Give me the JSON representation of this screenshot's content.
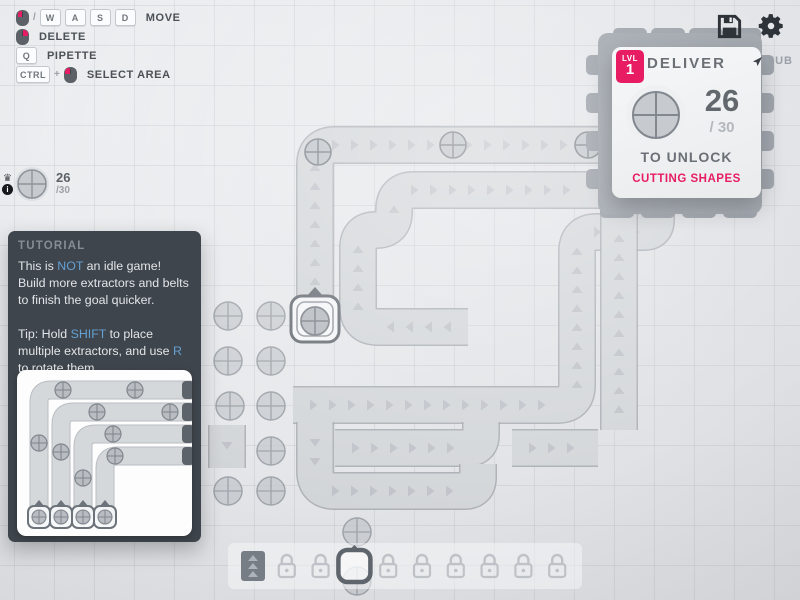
{
  "hints": {
    "rows": [
      {
        "keys": [
          "mouse-left",
          "/",
          "key:W",
          "key:A",
          "key:S",
          "key:D"
        ],
        "label": "MOVE"
      },
      {
        "keys": [
          "mouse-right"
        ],
        "label": "DELETE"
      },
      {
        "keys": [
          "key:Q"
        ],
        "label": "PIPETTE"
      },
      {
        "keys": [
          "key:CTRL",
          "+",
          "mouse-left"
        ],
        "label": "SELECT AREA"
      }
    ]
  },
  "pinned_goal": {
    "amount": "26",
    "total": "/30"
  },
  "hub_panel": {
    "level_label": "LVL",
    "level": "1",
    "title": "DELIVER",
    "hub_label": "HUB",
    "amount": "26",
    "total": "/ 30",
    "unlock": "TO UNLOCK",
    "reward": "CUTTING SHAPES"
  },
  "tutorial": {
    "header": "TUTORIAL",
    "paragraphs": [
      [
        {
          "t": "This is "
        },
        {
          "t": "NOT",
          "hl": true
        },
        {
          "t": " an idle game! Build more extractors and belts to finish the goal quicker."
        }
      ],
      [
        {
          "t": "Tip: Hold "
        },
        {
          "t": "SHIFT",
          "hl": true
        },
        {
          "t": " to place multiple extractors, and use "
        },
        {
          "t": "R",
          "hl": true
        },
        {
          "t": " to rotate them."
        }
      ]
    ]
  },
  "toolbar": {
    "slots": [
      "belt",
      "lock",
      "lock",
      "extractor",
      "lock",
      "lock",
      "lock",
      "lock",
      "lock",
      "lock"
    ],
    "selected_index": 3
  },
  "colors": {
    "accent_pink": "#e81c62",
    "accent_blue": "#64a0d2",
    "belt_fill": "#d5d8db",
    "belt_edge": "#a7acb2",
    "chevron": "#b2b7bd",
    "resource_fill": "#c7cbcf",
    "resource_edge": "#8d939a",
    "hub_tab": "#969ca4",
    "dark_icon": "#33383e"
  },
  "board": {
    "grid": 40,
    "belts": [
      {
        "id": "belt-extractor-to-hub-top",
        "pts": [
          [
            315,
            302
          ],
          [
            315,
            145
          ],
          [
            600,
            145
          ]
        ]
      },
      {
        "id": "belt-s-curve-to-hub",
        "pts": [
          [
            468,
            327
          ],
          [
            358,
            327
          ],
          [
            358,
            230
          ],
          [
            394,
            230
          ],
          [
            394,
            190
          ],
          [
            600,
            190
          ]
        ]
      },
      {
        "id": "belt-wide-to-hub-bottom",
        "pts": [
          [
            293,
            405
          ],
          [
            577,
            405
          ],
          [
            577,
            232
          ],
          [
            656,
            232
          ],
          [
            656,
            208
          ]
        ]
      },
      {
        "id": "belt-straight-riser",
        "pts": [
          [
            619,
            430
          ],
          [
            619,
            210
          ]
        ]
      },
      {
        "id": "belt-row-448",
        "pts": [
          [
            335,
            448
          ],
          [
            481,
            448
          ],
          [
            481,
            422
          ]
        ]
      },
      {
        "id": "belt-row-491",
        "pts": [
          [
            315,
            422
          ],
          [
            315,
            491
          ],
          [
            478,
            491
          ],
          [
            478,
            464
          ]
        ]
      },
      {
        "id": "belt-stub-right",
        "pts": [
          [
            512,
            448
          ],
          [
            598,
            448
          ]
        ]
      },
      {
        "id": "belt-stub-down",
        "pts": [
          [
            227,
            425
          ],
          [
            227,
            468
          ]
        ]
      }
    ],
    "resources": [
      [
        228,
        316
      ],
      [
        271,
        316
      ],
      [
        228,
        361
      ],
      [
        271,
        361
      ],
      [
        230,
        406
      ],
      [
        271,
        406
      ],
      [
        271,
        451
      ],
      [
        228,
        491
      ],
      [
        271,
        491
      ],
      [
        315,
        290
      ],
      [
        357,
        532
      ],
      [
        357,
        581
      ]
    ],
    "items_on_belts": [
      [
        318,
        152
      ],
      [
        453,
        145
      ],
      [
        588,
        145
      ]
    ],
    "extractor": {
      "x": 315,
      "y": 319
    },
    "hub": {
      "x": 598,
      "y": 33,
      "w": 164,
      "h": 181
    }
  },
  "tutorial_image": {
    "columns_x": [
      22,
      44,
      66,
      88
    ],
    "rows_y": [
      20,
      42,
      64,
      86
    ],
    "belt_bottom_y": 148,
    "belt_right_x": 176,
    "items": [
      [
        46,
        20
      ],
      [
        118,
        20
      ],
      [
        80,
        42
      ],
      [
        153,
        42
      ],
      [
        96,
        64
      ],
      [
        98,
        86
      ],
      [
        22,
        73
      ],
      [
        44,
        82
      ],
      [
        66,
        108
      ]
    ],
    "extractors_y": 148
  }
}
